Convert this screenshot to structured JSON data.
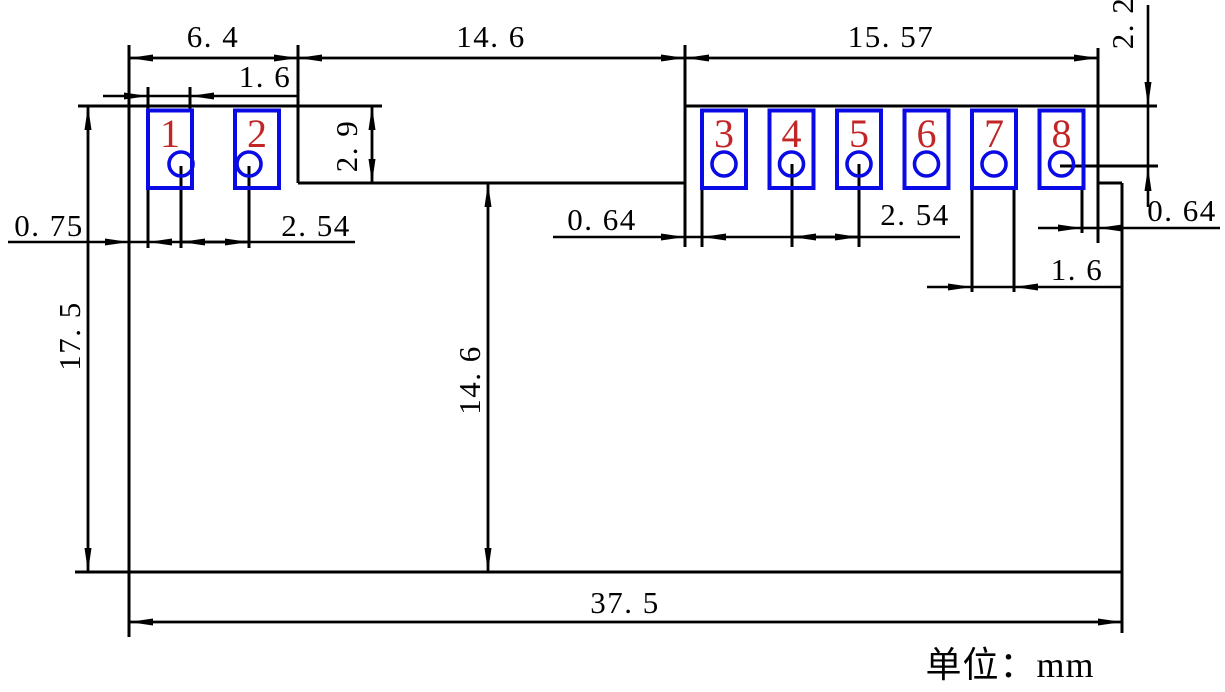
{
  "drawing": {
    "unit_label": "单位：mm",
    "pads": [
      {
        "number": "1"
      },
      {
        "number": "2"
      },
      {
        "number": "3"
      },
      {
        "number": "4"
      },
      {
        "number": "5"
      },
      {
        "number": "6"
      },
      {
        "number": "7"
      },
      {
        "number": "8"
      }
    ],
    "dims": {
      "left_block_width": "6. 4",
      "notch_width": "14. 6",
      "right_block_width": "15. 57",
      "pad1_width": "1. 6",
      "left_edge_to_pad1": "0. 75",
      "left_hole_pitch": "2. 54",
      "notch_depth": "2. 9",
      "notch_to_pad3": "0. 64",
      "right_hole_pitch": "2. 54",
      "top_to_hole8": "2. 2",
      "pad8_to_right_edge": "0. 64",
      "pad7_width": "1. 6",
      "overall_height": "17. 5",
      "notch_to_bottom": "14. 6",
      "overall_width": "37. 5"
    },
    "colors": {
      "line": "#000000",
      "pad": "#0a0ae6",
      "pin_number": "#c22626",
      "background": "#ffffff"
    }
  }
}
